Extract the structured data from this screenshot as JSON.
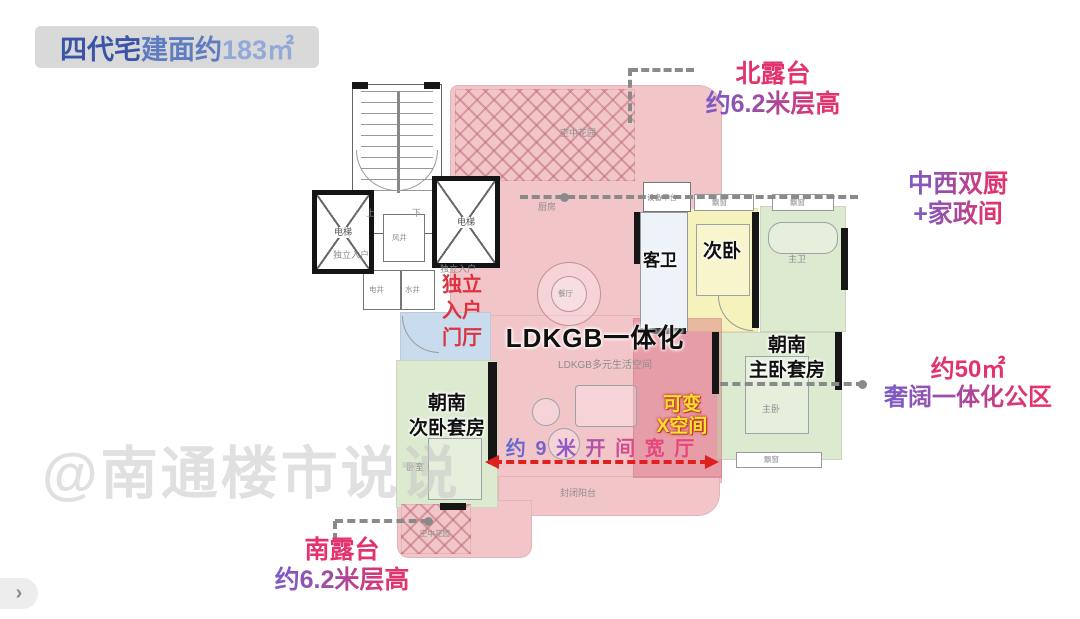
{
  "header": {
    "badge": {
      "t1": "四代宅",
      "t2": "建面约",
      "t3": "183㎡"
    }
  },
  "callouts": {
    "north_terrace": {
      "l1": "北露台",
      "l2": "约6.2米层高"
    },
    "dual_kitchen": {
      "l1": "中西双厨",
      "l2": "+家政间"
    },
    "private_foyer": {
      "l1": "独立",
      "l2": "入户",
      "l3": "门厅"
    },
    "variable_space": {
      "l1": "可变",
      "l2": "X空间"
    },
    "bay_width": {
      "text": "约 9 米 开 间 宽 厅"
    },
    "public_zone": {
      "l1": "约50㎡",
      "l2": "奢阔一体化公区"
    },
    "south_terrace": {
      "l1": "南露台",
      "l2": "约6.2米层高"
    }
  },
  "rooms": {
    "ldkgb_title": "LDKGB一体化",
    "ldkgb_sub": "LDKGB多元生活空间",
    "guest_bath": "客卫",
    "second_bedroom": "次卧",
    "master_suite": {
      "l1": "朝南",
      "l2": "主卧套房"
    },
    "south_suite": {
      "l1": "朝南",
      "l2": "次卧套房"
    },
    "sky_garden": "空中花园",
    "kitchen": "厨房",
    "dining": "餐厅",
    "equipment_platform": "设备平台",
    "master_bath": "主卫",
    "master_bedroom": "主卧",
    "bedroom": "卧室",
    "enclosed_balcony": "封闭阳台",
    "bay_window": "飘窗",
    "elevator": "电梯",
    "wind_shaft": "风井",
    "electric_shaft": "电井",
    "water_shaft": "水井",
    "up": "上",
    "down": "下",
    "private_entry": "独立入户"
  },
  "watermark": "@南通楼市说说",
  "pager": {
    "chevron": "›"
  },
  "colors": {
    "pink_zone": "#f2c5c8",
    "variable_zone": "#d65c70",
    "yellow_zone": "#f6f2bb",
    "green_zone": "#dceacf",
    "blue_zone": "#c8dcee",
    "accent_purple": "#7a5cc8",
    "accent_pink": "#e2336e",
    "leader_gray": "#8a8a8a",
    "arrow_red": "#e01f1f",
    "badge_blue": "#3a55a8"
  }
}
